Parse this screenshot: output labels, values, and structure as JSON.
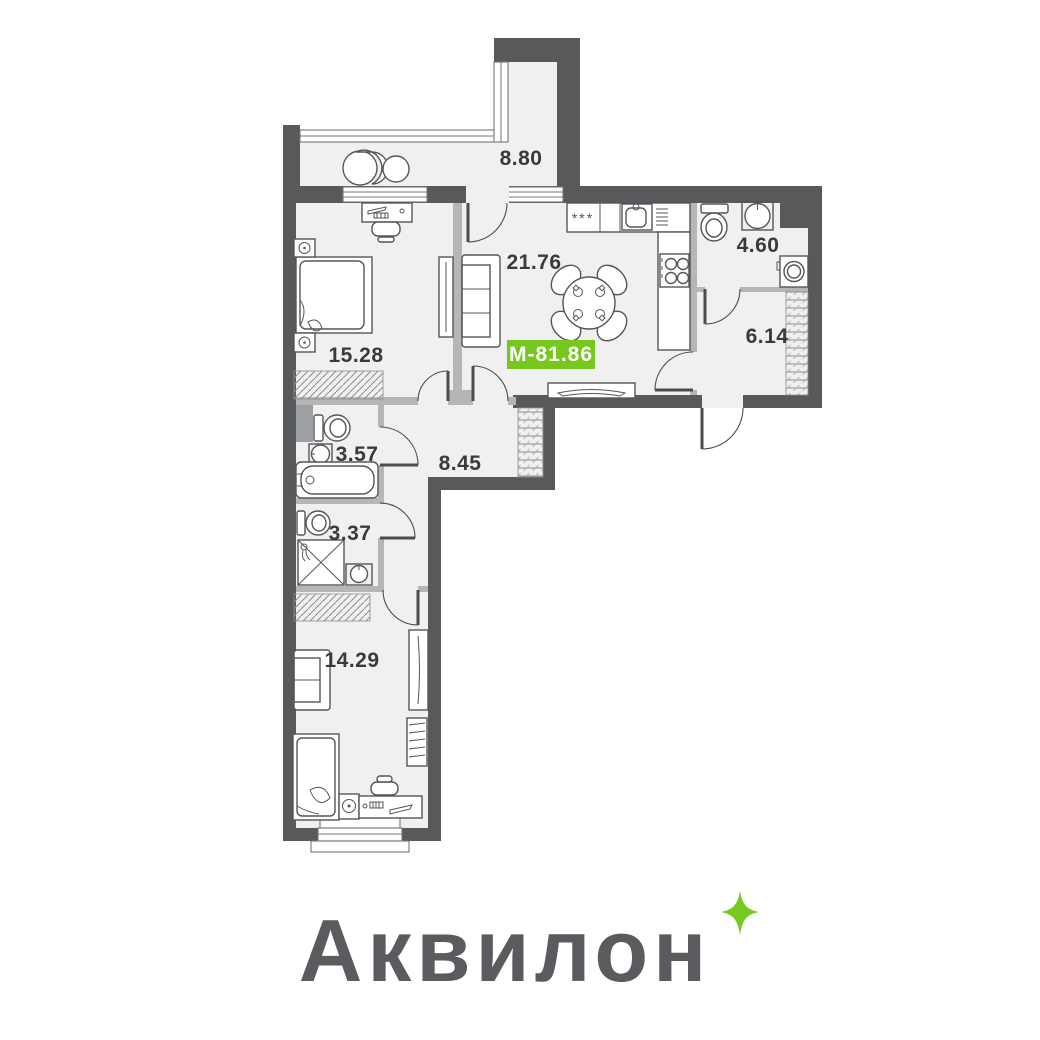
{
  "floorplan": {
    "total_area_badge": {
      "label": "М-81.86",
      "color": "#76c81f"
    },
    "rooms": [
      {
        "name": "balcony",
        "area": "8.80"
      },
      {
        "name": "kitchen-living-room",
        "area": "21.76"
      },
      {
        "name": "bathroom",
        "area": "4.60"
      },
      {
        "name": "entrance-hall",
        "area": "6.14"
      },
      {
        "name": "bedroom",
        "area": "15.28"
      },
      {
        "name": "wc",
        "area": "3.57"
      },
      {
        "name": "corridor",
        "area": "8.45"
      },
      {
        "name": "shower-room",
        "area": "3.37"
      },
      {
        "name": "bedroom-2",
        "area": "14.29"
      }
    ],
    "fixtures": {
      "freezer_label": "***"
    }
  },
  "logo": {
    "text": "Аквилон",
    "color": "#595b5e",
    "sparkle_color": "#76c91f"
  },
  "colors": {
    "wall": "#58595b",
    "partition": "#b6b6b6",
    "floor": "#f0f0f1",
    "background": "#ffffff",
    "label_text": "#3a3a3c",
    "badge_text": "#ffffff"
  }
}
